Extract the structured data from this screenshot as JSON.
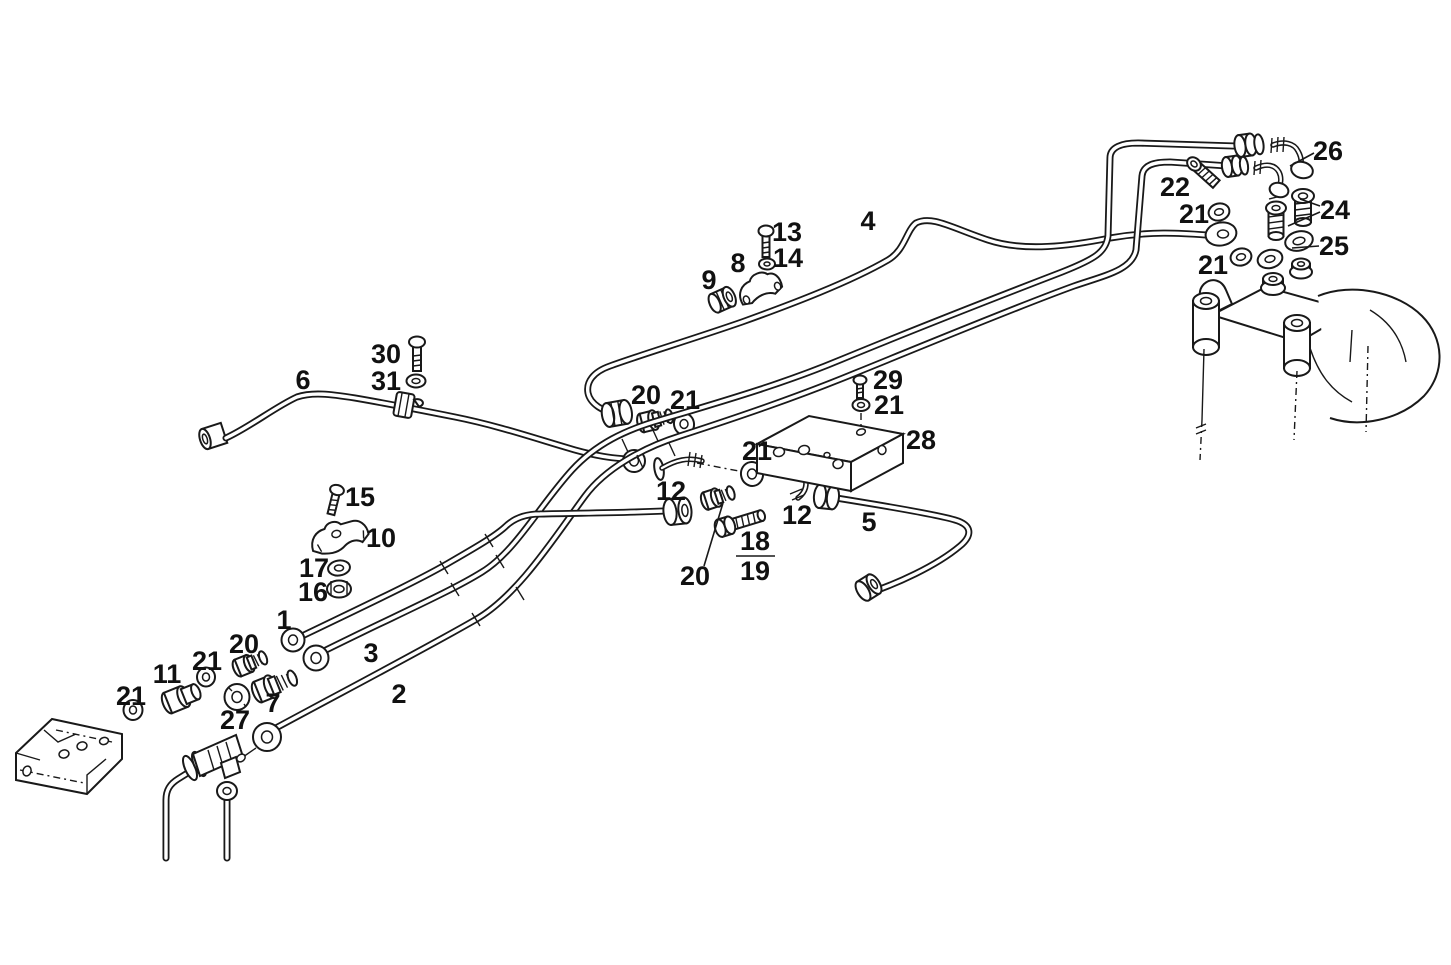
{
  "diagram": {
    "type": "exploded-parts-line-diagram",
    "subject": "fuel injection pipe and fitting assembly",
    "colors": {
      "background": "#ffffff",
      "ink": "#191919",
      "label_text": "#111111"
    },
    "labels": [
      {
        "text": "1",
        "x": 284,
        "y": 620
      },
      {
        "text": "2",
        "x": 399,
        "y": 694
      },
      {
        "text": "3",
        "x": 371,
        "y": 653
      },
      {
        "text": "4",
        "x": 868,
        "y": 221
      },
      {
        "text": "5",
        "x": 869,
        "y": 522
      },
      {
        "text": "6",
        "x": 303,
        "y": 380
      },
      {
        "text": "7",
        "x": 273,
        "y": 703
      },
      {
        "text": "8",
        "x": 738,
        "y": 263
      },
      {
        "text": "9",
        "x": 709,
        "y": 280
      },
      {
        "text": "10",
        "x": 381,
        "y": 538
      },
      {
        "text": "11",
        "x": 167,
        "y": 674
      },
      {
        "text": "12",
        "x": 671,
        "y": 491
      },
      {
        "text": "12",
        "x": 797,
        "y": 515
      },
      {
        "text": "13",
        "x": 787,
        "y": 232
      },
      {
        "text": "14",
        "x": 788,
        "y": 258
      },
      {
        "text": "15",
        "x": 360,
        "y": 497
      },
      {
        "text": "16",
        "x": 313,
        "y": 592
      },
      {
        "text": "17",
        "x": 314,
        "y": 568
      },
      {
        "text": "18",
        "x": 755,
        "y": 541
      },
      {
        "text": "19",
        "x": 755,
        "y": 571
      },
      {
        "text": "20",
        "x": 646,
        "y": 395
      },
      {
        "text": "20",
        "x": 244,
        "y": 644
      },
      {
        "text": "20",
        "x": 695,
        "y": 576
      },
      {
        "text": "21",
        "x": 685,
        "y": 400
      },
      {
        "text": "21",
        "x": 889,
        "y": 405
      },
      {
        "text": "21",
        "x": 757,
        "y": 451
      },
      {
        "text": "21",
        "x": 207,
        "y": 661
      },
      {
        "text": "21",
        "x": 131,
        "y": 696
      },
      {
        "text": "21",
        "x": 1194,
        "y": 214
      },
      {
        "text": "21",
        "x": 1213,
        "y": 265
      },
      {
        "text": "22",
        "x": 1175,
        "y": 187
      },
      {
        "text": "24",
        "x": 1335,
        "y": 210
      },
      {
        "text": "25",
        "x": 1334,
        "y": 246
      },
      {
        "text": "26",
        "x": 1328,
        "y": 151
      },
      {
        "text": "27",
        "x": 235,
        "y": 720
      },
      {
        "text": "28",
        "x": 921,
        "y": 440
      },
      {
        "text": "29",
        "x": 888,
        "y": 380
      },
      {
        "text": "30",
        "x": 386,
        "y": 354
      },
      {
        "text": "31",
        "x": 386,
        "y": 381
      }
    ],
    "fraction_bar": {
      "x1": 736,
      "y1": 556,
      "x2": 775,
      "y2": 556
    },
    "leaders": [
      {
        "x1": 704,
        "y1": 566,
        "x2": 723,
        "y2": 503
      },
      {
        "x1": 1314,
        "y1": 153,
        "x2": 1290,
        "y2": 166
      },
      {
        "x1": 1320,
        "y1": 206,
        "x2": 1300,
        "y2": 199
      },
      {
        "x1": 1320,
        "y1": 212,
        "x2": 1288,
        "y2": 226
      },
      {
        "x1": 1319,
        "y1": 246,
        "x2": 1292,
        "y2": 248
      }
    ]
  }
}
